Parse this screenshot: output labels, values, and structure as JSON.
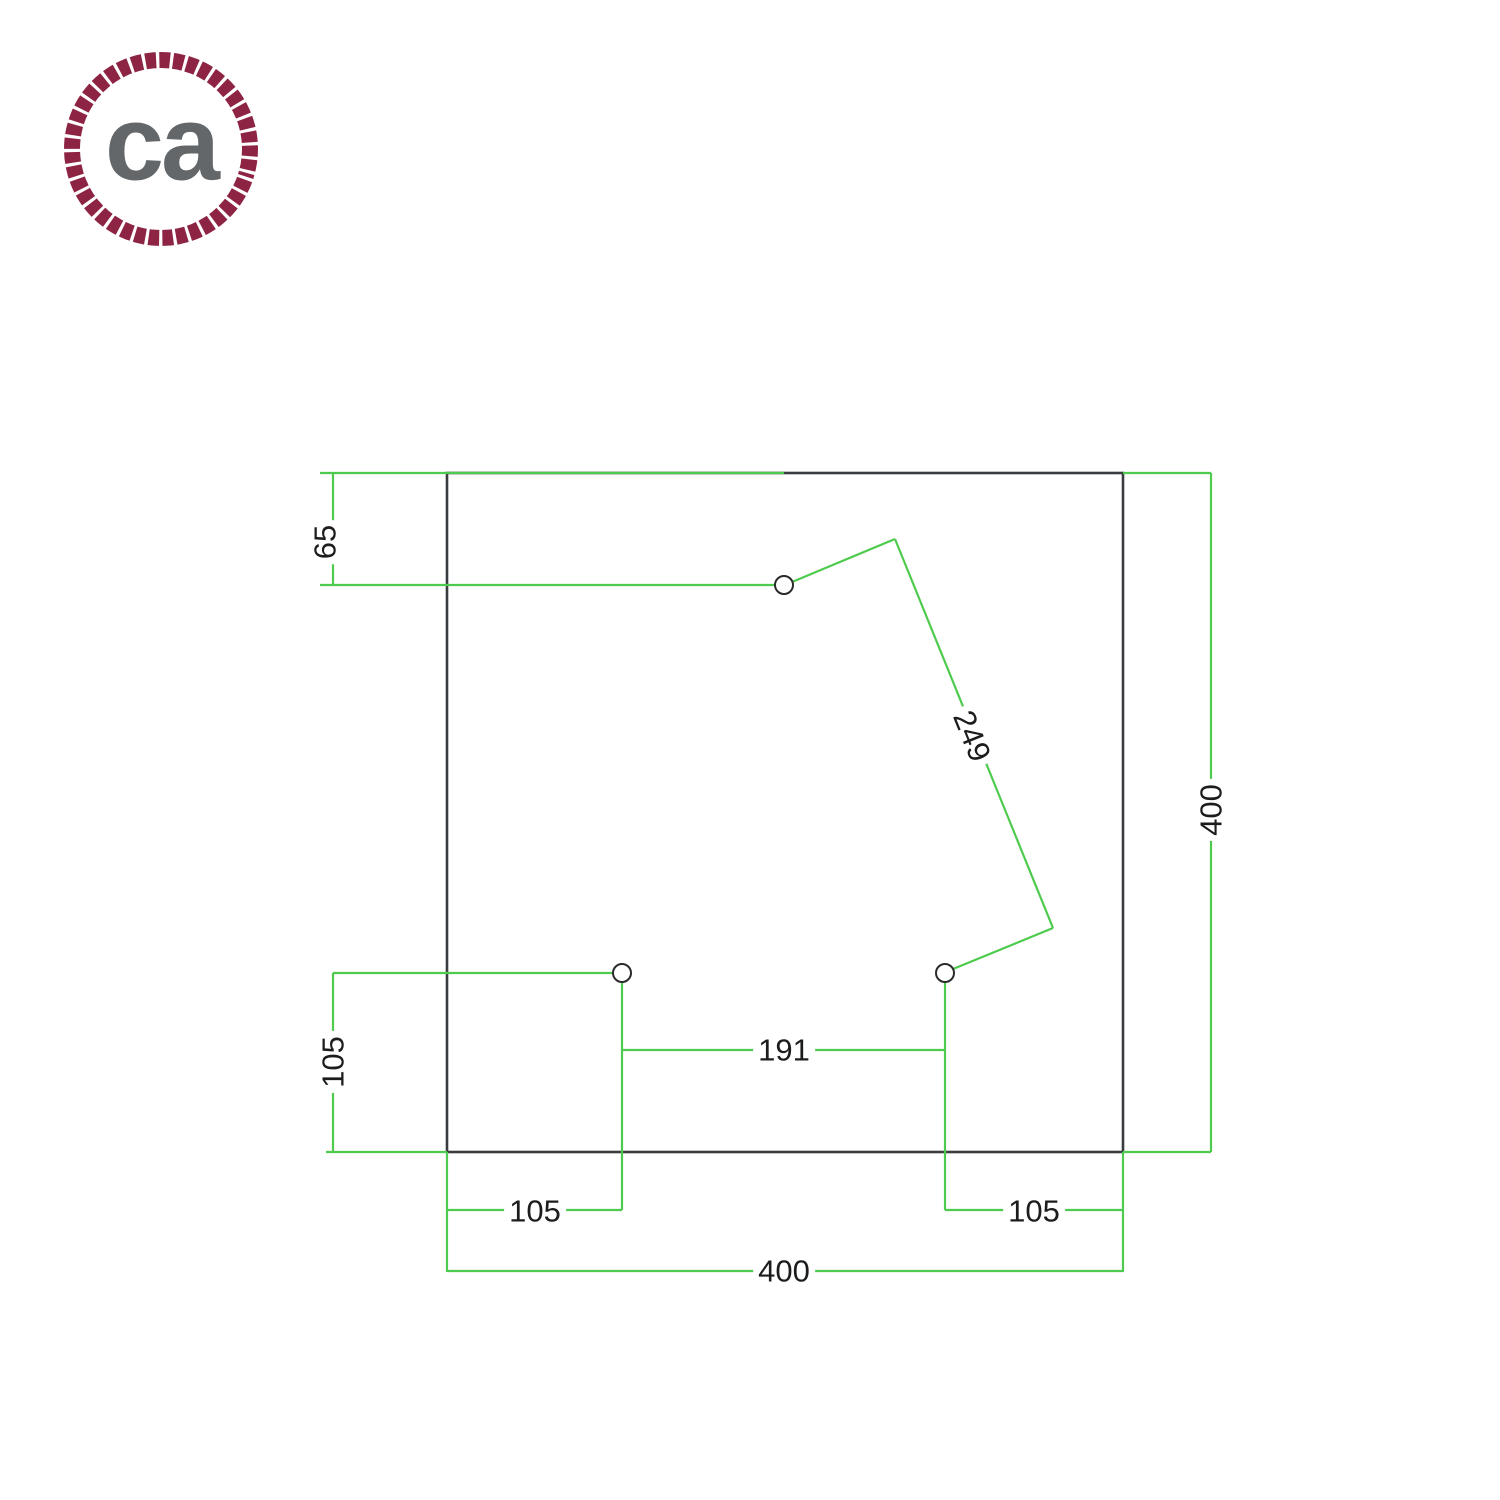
{
  "canvas": {
    "width": 1500,
    "height": 1500,
    "background": "#ffffff"
  },
  "logo": {
    "text": "ca",
    "rope_color": "#8E2443",
    "text_color": "#63676A"
  },
  "drawing": {
    "line_color": "#4ECB4E",
    "outline_color": "#3A3D40",
    "hole_stroke": "#2B2B2B",
    "label_color": "#1C1C1C",
    "plate": {
      "x": 447,
      "y": 473,
      "width": 676,
      "height": 679
    },
    "holes": [
      {
        "name": "top-hole",
        "cx": 784,
        "cy": 585,
        "r": 9
      },
      {
        "name": "bottom-left-hole",
        "cx": 622,
        "cy": 973,
        "r": 9
      },
      {
        "name": "bottom-right-hole",
        "cx": 945,
        "cy": 973,
        "r": 9
      }
    ],
    "dim_lines": [
      {
        "x1": 320,
        "y1": 473,
        "x2": 784,
        "y2": 473
      },
      {
        "x1": 320,
        "y1": 585,
        "x2": 775,
        "y2": 585
      },
      {
        "x1": 333,
        "y1": 473,
        "x2": 333,
        "y2": 585
      },
      {
        "x1": 1123,
        "y1": 473,
        "x2": 1211,
        "y2": 473
      },
      {
        "x1": 1211,
        "y1": 473,
        "x2": 1211,
        "y2": 1152
      },
      {
        "x1": 1123,
        "y1": 1152,
        "x2": 1211,
        "y2": 1152
      },
      {
        "x1": 333,
        "y1": 973,
        "x2": 613,
        "y2": 973
      },
      {
        "x1": 333,
        "y1": 973,
        "x2": 333,
        "y2": 1152
      },
      {
        "x1": 326,
        "y1": 1152,
        "x2": 447,
        "y2": 1152
      },
      {
        "x1": 622,
        "y1": 982,
        "x2": 622,
        "y2": 1210
      },
      {
        "x1": 945,
        "y1": 982,
        "x2": 945,
        "y2": 1210
      },
      {
        "x1": 622,
        "y1": 1050,
        "x2": 945,
        "y2": 1050
      },
      {
        "x1": 447,
        "y1": 1210,
        "x2": 622,
        "y2": 1210
      },
      {
        "x1": 945,
        "y1": 1210,
        "x2": 1123,
        "y2": 1210
      },
      {
        "x1": 447,
        "y1": 1152,
        "x2": 447,
        "y2": 1272
      },
      {
        "x1": 1123,
        "y1": 1152,
        "x2": 1123,
        "y2": 1272
      },
      {
        "x1": 447,
        "y1": 1271,
        "x2": 1123,
        "y2": 1271
      },
      {
        "x1": 792,
        "y1": 582,
        "x2": 895,
        "y2": 539
      },
      {
        "x1": 895,
        "y1": 539,
        "x2": 1053,
        "y2": 928
      },
      {
        "x1": 1053,
        "y1": 928,
        "x2": 953,
        "y2": 969
      }
    ],
    "labels": [
      {
        "text": "65",
        "x": 325,
        "y": 542,
        "rot": -90
      },
      {
        "text": "105",
        "x": 333,
        "y": 1062,
        "rot": -90
      },
      {
        "text": "400",
        "x": 1211,
        "y": 810,
        "rot": -90
      },
      {
        "text": "249",
        "x": 972,
        "y": 736,
        "rot": 68
      },
      {
        "text": "191",
        "x": 784,
        "y": 1050,
        "rot": 0
      },
      {
        "text": "105",
        "x": 535,
        "y": 1211,
        "rot": 0
      },
      {
        "text": "105",
        "x": 1034,
        "y": 1211,
        "rot": 0
      },
      {
        "text": "400",
        "x": 784,
        "y": 1271,
        "rot": 0
      }
    ]
  }
}
